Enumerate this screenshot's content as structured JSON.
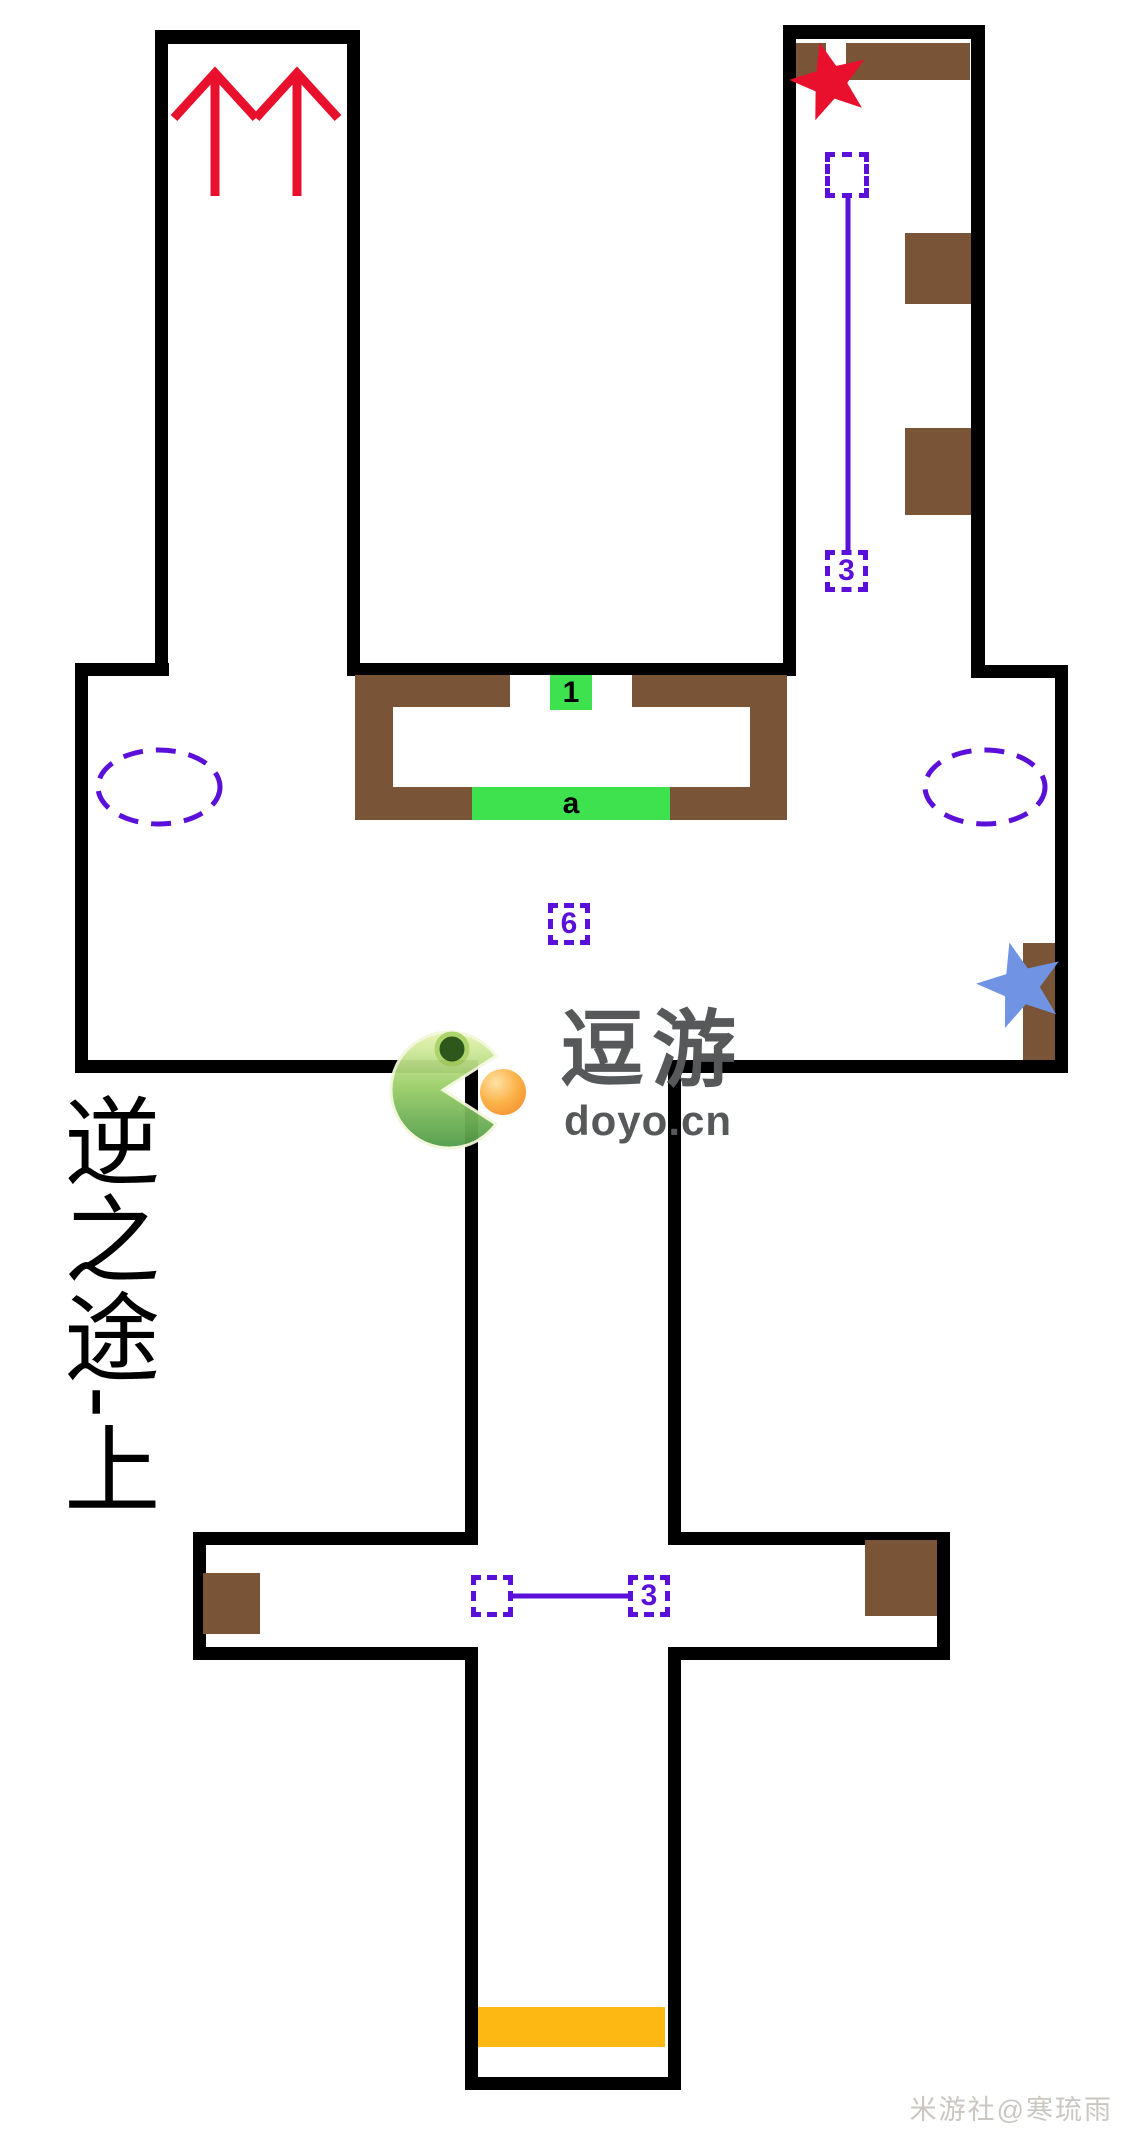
{
  "map": {
    "region_label": "逆之途-上",
    "watermark_center": {
      "title": "逗游",
      "domain": "doyo.cn"
    },
    "watermark_corner": "米游社@寒琉雨",
    "colors": {
      "wall": "#000000",
      "platform": "#7a5437",
      "marker": "#5a10d8",
      "green": "#3ee14e",
      "orange": "#fdb813",
      "red": "#e8102c",
      "blue": "#7093e3"
    },
    "walls": [
      [
        155,
        30,
        205,
        14
      ],
      [
        155,
        30,
        13,
        645
      ],
      [
        347,
        30,
        13,
        646
      ],
      [
        783,
        25,
        202,
        14
      ],
      [
        783,
        25,
        13,
        651
      ],
      [
        971,
        25,
        14,
        653
      ],
      [
        75,
        663,
        94,
        13
      ],
      [
        347,
        663,
        449,
        13
      ],
      [
        971,
        665,
        97,
        13
      ],
      [
        75,
        663,
        13,
        410
      ],
      [
        1055,
        665,
        13,
        408
      ],
      [
        75,
        1060,
        403,
        13
      ],
      [
        668,
        1060,
        400,
        13
      ],
      [
        465,
        1060,
        13,
        485
      ],
      [
        668,
        1060,
        13,
        485
      ],
      [
        193,
        1532,
        285,
        13
      ],
      [
        668,
        1532,
        282,
        13
      ],
      [
        193,
        1532,
        13,
        128
      ],
      [
        937,
        1532,
        13,
        128
      ],
      [
        193,
        1647,
        285,
        13
      ],
      [
        668,
        1647,
        282,
        13
      ],
      [
        465,
        1647,
        13,
        443
      ],
      [
        668,
        1647,
        13,
        443
      ],
      [
        465,
        2077,
        216,
        13
      ]
    ],
    "brown_blocks": [
      [
        796,
        43,
        30,
        37
      ],
      [
        846,
        43,
        124,
        37
      ],
      [
        905,
        233,
        66,
        71
      ],
      [
        905,
        428,
        66,
        87
      ],
      [
        355,
        675,
        432,
        145
      ],
      [
        1023,
        943,
        32,
        117
      ],
      [
        203,
        1573,
        57,
        61
      ],
      [
        865,
        1540,
        72,
        76
      ]
    ],
    "white_cutouts": [
      [
        393,
        707,
        357,
        80
      ],
      [
        510,
        675,
        40,
        33
      ],
      [
        592,
        675,
        40,
        33
      ]
    ],
    "green_zones": [
      {
        "x": 550,
        "y": 675,
        "w": 42,
        "h": 35,
        "label": "1"
      },
      {
        "x": 472,
        "y": 787,
        "w": 198,
        "h": 33,
        "label": "a"
      }
    ],
    "orange_zones": [
      {
        "x": 478,
        "y": 2007,
        "w": 187,
        "h": 40
      }
    ],
    "dashed_boxes": [
      {
        "x": 825,
        "y": 152,
        "w": 44,
        "h": 46,
        "label": ""
      },
      {
        "x": 825,
        "y": 550,
        "w": 43,
        "h": 42,
        "label": "3"
      },
      {
        "x": 548,
        "y": 903,
        "w": 42,
        "h": 42,
        "label": "6"
      },
      {
        "x": 471,
        "y": 1575,
        "w": 42,
        "h": 42,
        "label": ""
      },
      {
        "x": 628,
        "y": 1575,
        "w": 42,
        "h": 42,
        "label": "3"
      }
    ],
    "connector_lines": [
      [
        848,
        198,
        848,
        550
      ],
      [
        513,
        1596,
        628,
        1596
      ]
    ],
    "dashed_ellipses": [
      {
        "cx": 159,
        "cy": 787,
        "rx": 61,
        "ry": 37
      },
      {
        "cx": 985,
        "cy": 787,
        "rx": 60,
        "ry": 37
      }
    ],
    "stars": [
      {
        "name": "red-star-marker",
        "cx": 830,
        "cy": 82,
        "r": 41,
        "rot": -15,
        "color": "#e8102c"
      },
      {
        "name": "blue-star-marker",
        "cx": 1021,
        "cy": 986,
        "r": 45,
        "rot": -15,
        "color": "#7093e3"
      }
    ],
    "arrows": [
      {
        "tipx": 215,
        "tipy": 73
      },
      {
        "tipx": 297,
        "tipy": 73
      }
    ]
  }
}
